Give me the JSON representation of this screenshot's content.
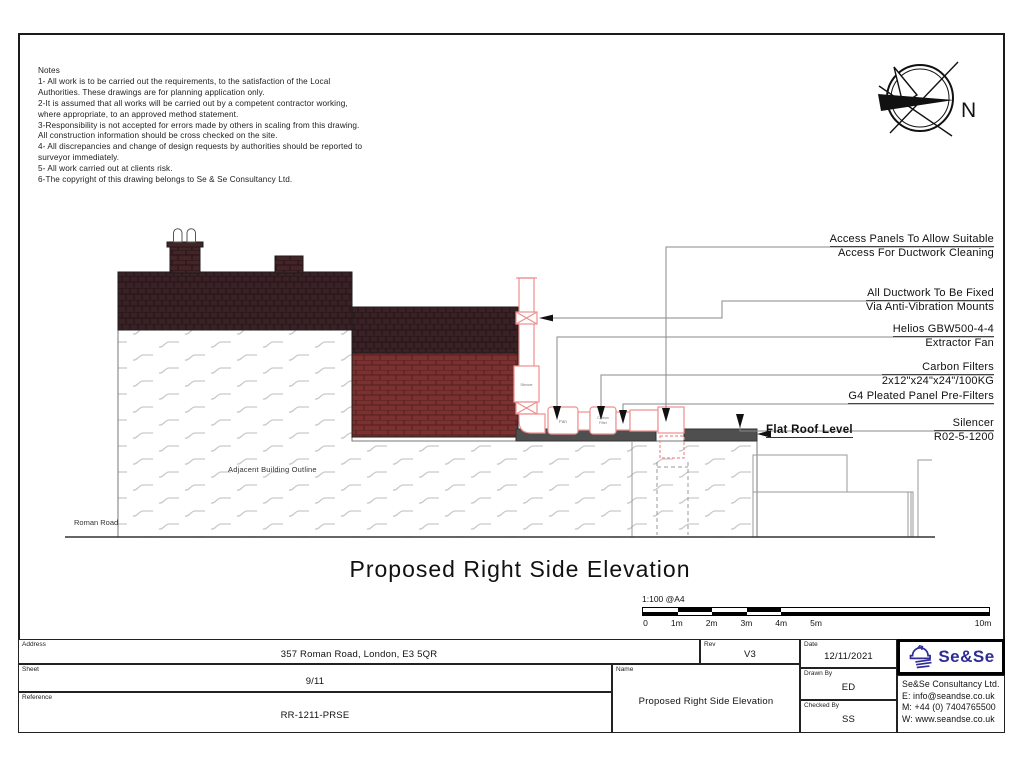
{
  "notes": {
    "heading": "Notes",
    "body": "1- All work is to be carried out the requirements, to the satisfaction of the Local\nAuthorities. These drawings are for planning application only.\n2-It is assumed that all works will be carried out by a competent contractor working,\nwhere appropriate, to an approved method statement.\n3-Responsibility is not accepted for errors made by others in scaling from this drawing.\nAll construction information should be cross checked on the site.\n4- All discrepancies and change of design requests by authorities should be reported to\nsurveyor immediately.\n5- All work carried out at clients risk.\n6-The copyright of this drawing belongs to Se & Se Consultancy Ltd."
  },
  "compass": {
    "north_label": "N"
  },
  "drawing": {
    "road_label": "Roman Road",
    "adjacent_building_label": "Adjacent Building Outline",
    "flat_roof_label": "Flat Roof Level",
    "silencer_tag": "Silencer",
    "fan_tag": "Fan",
    "carbon_tag_line1": "Carbon",
    "carbon_tag_line2": "Filter"
  },
  "annotations": [
    {
      "line1": "Access Panels To Allow Suitable",
      "line2": "Access For Ductwork Cleaning"
    },
    {
      "line1": "All Ductwork To Be Fixed",
      "line2": "Via Anti-Vibration Mounts"
    },
    {
      "line1": "Helios GBW500-4-4",
      "line2": "Extractor Fan"
    },
    {
      "line1": "Carbon Filters",
      "line2": "2x12\"x24\"x24\"/100KG"
    },
    {
      "line1": "G4 Pleated Panel Pre-Filters"
    },
    {
      "line1": "Silencer",
      "line2": "R02-5-1200"
    }
  ],
  "main_title": "Proposed Right Side Elevation",
  "scale_bar": {
    "label": "1:100 @A4",
    "ticks": [
      "0",
      "1m",
      "2m",
      "3m",
      "4m",
      "5m",
      "10m"
    ]
  },
  "title_block": {
    "address_label": "Address",
    "address": "357 Roman Road, London, E3 5QR",
    "sheet_label": "Sheet",
    "sheet": "9/11",
    "reference_label": "Reference",
    "reference": "RR-1211-PRSE",
    "name_label": "Name",
    "name": "Proposed Right Side Elevation",
    "rev_label": "Rev",
    "rev": "V3",
    "date_label": "Date",
    "date": "12/11/2021",
    "drawn_label": "Drawn By",
    "drawn": "ED",
    "checked_label": "Checked By",
    "checked": "SS",
    "company": {
      "logo_text": "Se&Se",
      "name": "Se&Se Consultancy Ltd.",
      "email": "E: info@seandse.co.uk",
      "phone": "M: +44 (0) 7404765500",
      "website": "W: www.seandse.co.uk"
    }
  },
  "colors": {
    "roof_tile": "#3a2125",
    "brick": "#7c3131",
    "duct_outline": "#ef8f8f",
    "flat_roof": "#4f4f4f",
    "logo_blue": "#2f2c96"
  }
}
